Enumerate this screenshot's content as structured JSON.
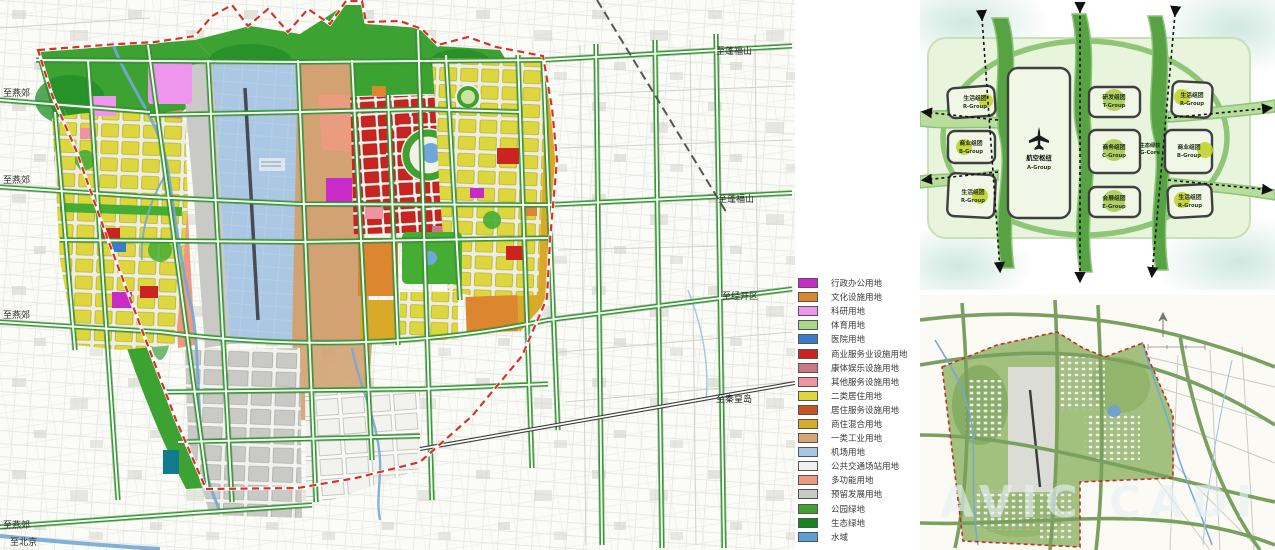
{
  "map": {
    "road_labels": [
      "至燕郊",
      "至燕郊",
      "至燕郊",
      "至燕郊",
      "至北京",
      "至蓬福山",
      "至蓬福山",
      "至经开区",
      "至秦皇岛"
    ]
  },
  "legend": {
    "items": [
      {
        "label": "行政办公用地",
        "color": "#c92bc9"
      },
      {
        "label": "文化设施用地",
        "color": "#dd8630"
      },
      {
        "label": "科研用地",
        "color": "#ef96ee"
      },
      {
        "label": "体育用地",
        "color": "#a7d787"
      },
      {
        "label": "医院用地",
        "color": "#3a7ccb"
      },
      {
        "label": "商业服务业设施用地",
        "color": "#cb2420"
      },
      {
        "label": "康体娱乐设施用地",
        "color": "#c97884"
      },
      {
        "label": "其他服务设施用地",
        "color": "#ef93a2"
      },
      {
        "label": "二类居住用地",
        "color": "#ddd63f"
      },
      {
        "label": "居住服务设施用地",
        "color": "#c8551f"
      },
      {
        "label": "商住混合用地",
        "color": "#d9a92a"
      },
      {
        "label": "一类工业用地",
        "color": "#d4a577"
      },
      {
        "label": "机场用地",
        "color": "#a9c6e3"
      },
      {
        "label": "公共交通场站用地",
        "color": "#f0f0ee"
      },
      {
        "label": "多功能用地",
        "color": "#ec9b82"
      },
      {
        "label": "预留发展用地",
        "color": "#c9c9c7"
      },
      {
        "label": "公园绿地",
        "color": "#3fa12f"
      },
      {
        "label": "生态绿地",
        "color": "#14861f"
      },
      {
        "label": "水域",
        "color": "#5b9fd4"
      }
    ]
  },
  "concept": {
    "hub": {
      "name": "航空枢纽",
      "code": "A-Group"
    },
    "core": {
      "name": "生态绿核",
      "code": "G-Core"
    },
    "cells": [
      {
        "name": "生活组团",
        "code": "R-Group"
      },
      {
        "name": "商业组团",
        "code": "B-Group"
      },
      {
        "name": "生活组团",
        "code": "R-Group"
      },
      {
        "name": "研发组团",
        "code": "T-Group"
      },
      {
        "name": "商务组团",
        "code": "C-Group"
      },
      {
        "name": "会展组团",
        "code": "E-Group"
      },
      {
        "name": "生活组团",
        "code": "R-Group"
      },
      {
        "name": "商业组团",
        "code": "B-Group"
      },
      {
        "name": "生活组团",
        "code": "R-Group"
      }
    ]
  },
  "render": {
    "watermark": "AVIC CADI"
  }
}
